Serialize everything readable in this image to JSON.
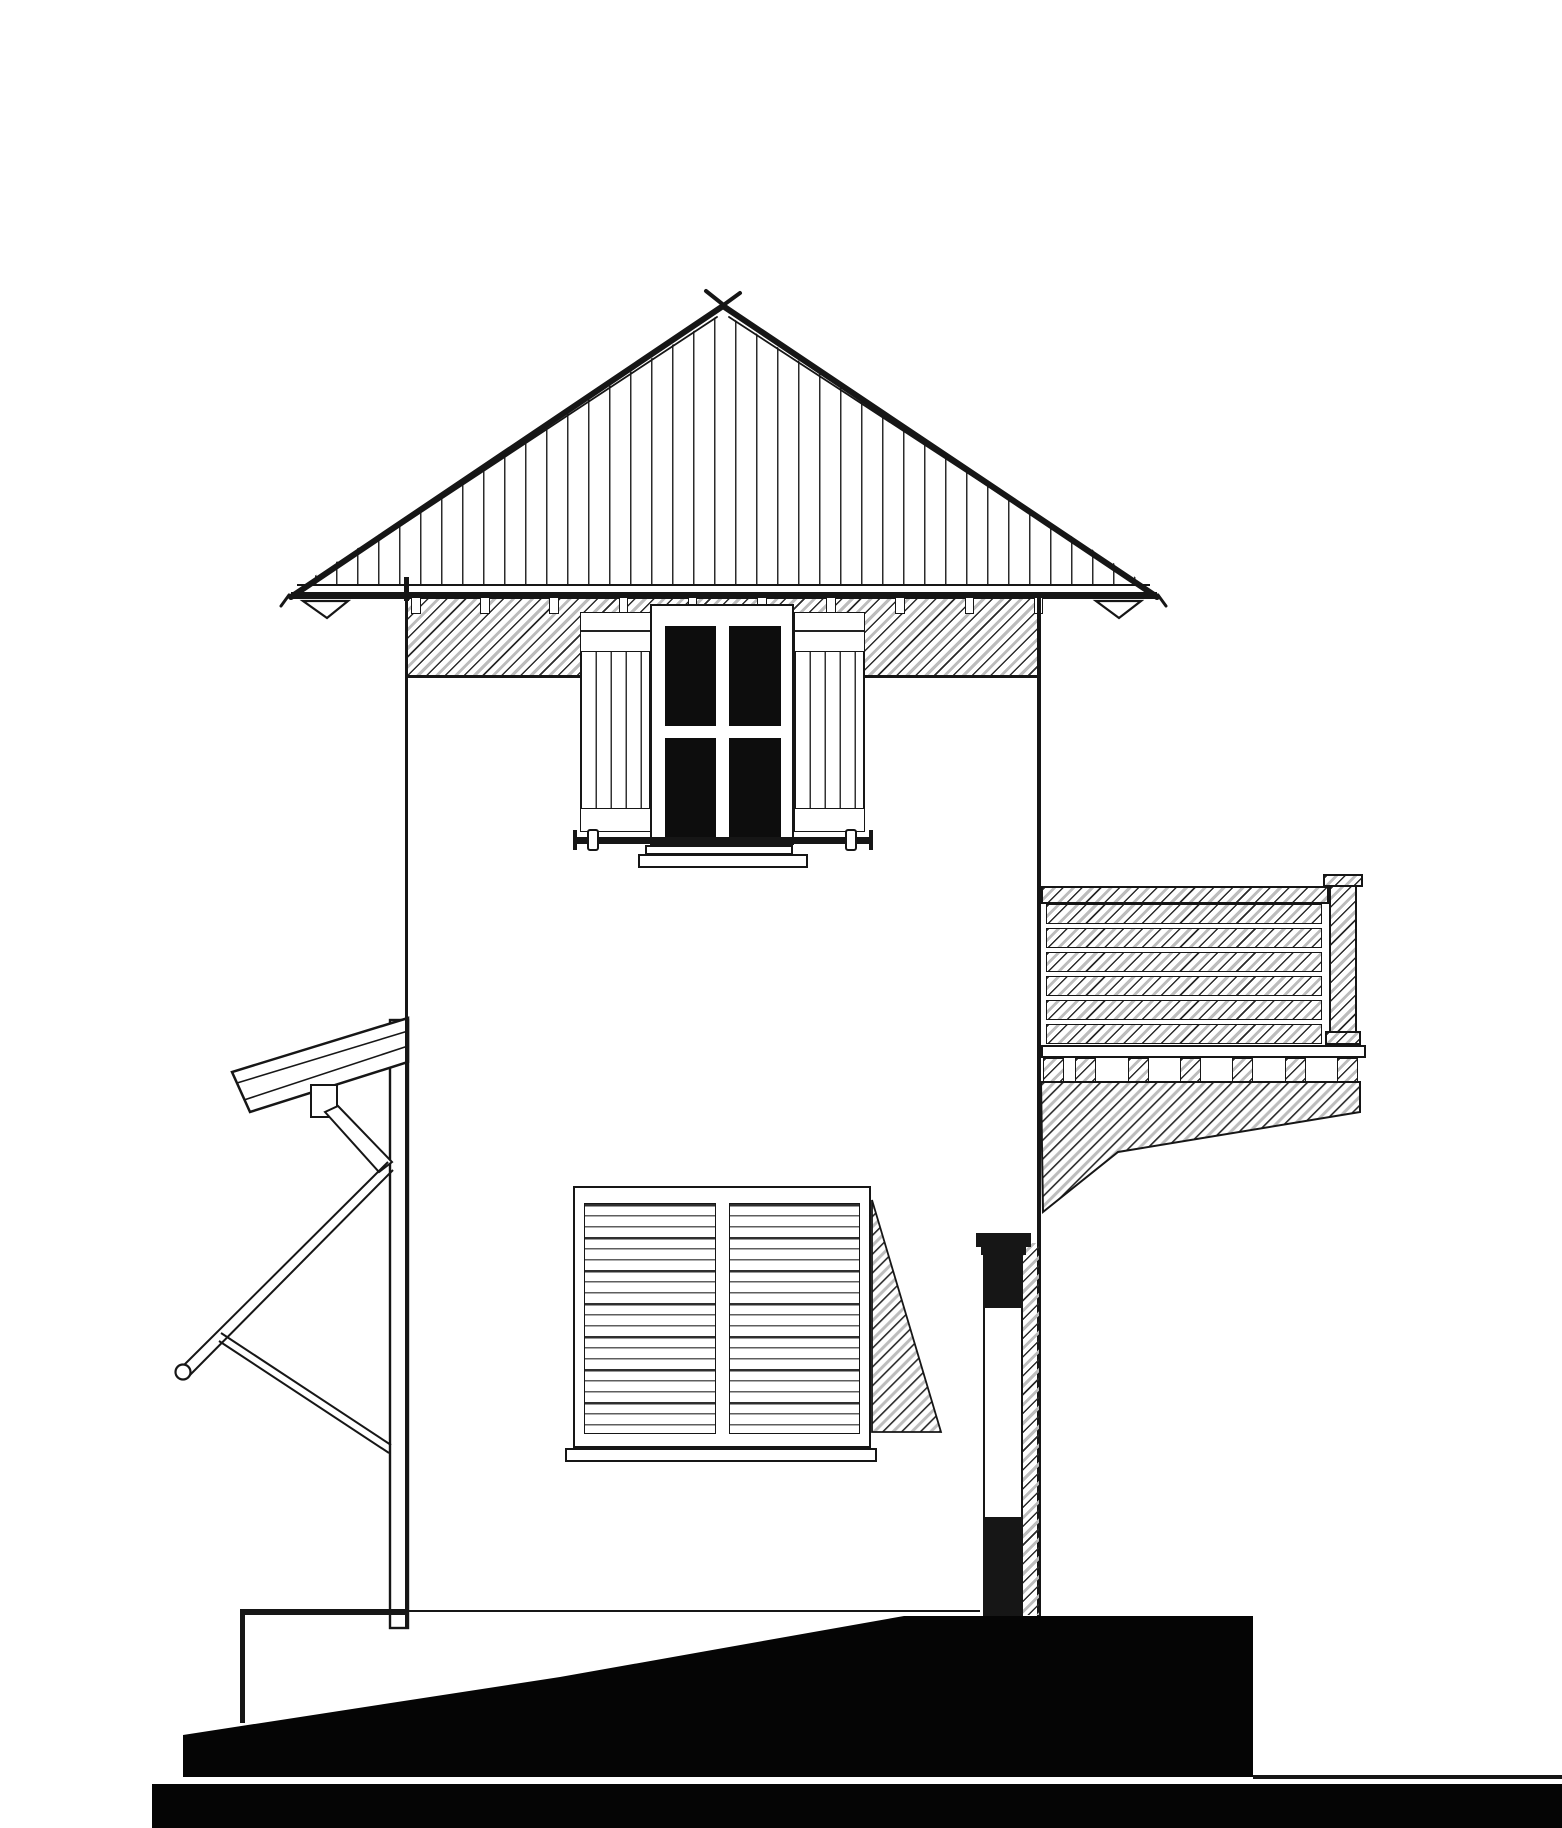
{
  "title": "Hand-drafted side elevation of a two-storey tower house",
  "drawing": {
    "type": "architectural-elevation",
    "style": "black ink line drawing on white paper",
    "colors": {
      "ink": "#161616",
      "paper": "#ffffff",
      "hatch_gray": "#bdbdbd",
      "glazing_black": "#0d0d0d",
      "terrain_black": "#050505"
    },
    "parts": {
      "roof": "hip roof with vertical standing-seam hatching, apex x-mark, wide eaves with fascia and corner brackets",
      "frieze": "diagonally hatched eave band with exposed rafter tails",
      "upper_window": "four-pane dark glazed window with open board shutters, guard rod and flower-box sill",
      "balcony": "hatched railing with horizontal boards, corner post, deck band, joist dentils and tapered underside",
      "chimney": "stove pipe with black cap, black top section, white middle section, black base",
      "lean_to": "left annex: sloped roof slab, downspout block with diagonal chute, slender post, two diagonal braces",
      "lower_window": "louvered shutter pair with center stile and projected open-shutter triangle",
      "terrain": "sloped solid black ground mound rising left-to-right onto a plateau, over a full-width black base strip"
    },
    "rafter_tails": {
      "count": 10,
      "x_start": 411,
      "spacing": 69.2,
      "width": 9.5,
      "top": 598,
      "height": 16
    },
    "balcony_rows": {
      "count": 6,
      "x": 1046,
      "width": 276,
      "y_start": 904,
      "step": 24,
      "height": 20
    },
    "dentils": {
      "xs": [
        1043,
        1075,
        1128,
        1180,
        1232,
        1285,
        1337
      ],
      "width": 21,
      "top": 1058,
      "height": 24
    }
  }
}
